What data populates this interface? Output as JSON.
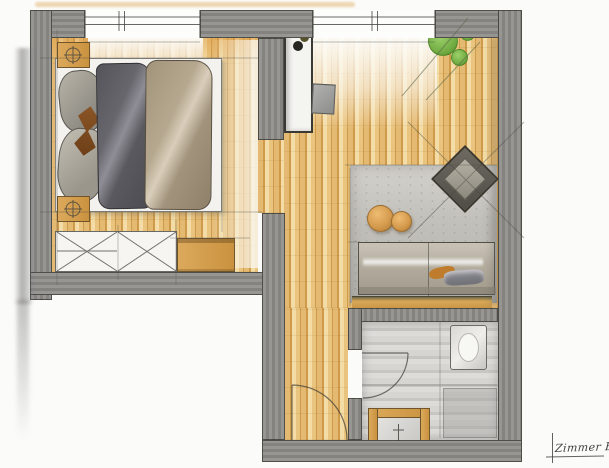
{
  "annotation": {
    "room_label": "Zimmer B"
  },
  "colors": {
    "paper": "#fbfbf9",
    "wall": "#8e8d8a",
    "wall-dark": "#6f6e6b",
    "wood": "#e4ba72",
    "wood-dark": "#cf9a49",
    "wood-light": "#f3dca6",
    "wood-furniture": "#dca95c",
    "rug": "#c6c4bf",
    "bath-floor": "#cfcecb",
    "mattress": "#f3f2ef",
    "duvet-dark": "#5e5d63",
    "duvet-light": "#b2a48c",
    "pouf": "#d59b4e",
    "plant": "#74ae45",
    "plant-dark": "#4e8a28",
    "sofa": "#b7b0a3",
    "pencil": "#55544e",
    "ink": "#403f3a"
  },
  "rooms": [
    {
      "name": "bedroom",
      "furniture": [
        "double-bed",
        "nightstand-left-top",
        "nightstand-left-bottom",
        "wardrobe",
        "dresser"
      ]
    },
    {
      "name": "study-corner",
      "furniture": [
        "desk",
        "desk-chair"
      ]
    },
    {
      "name": "living-area",
      "furniture": [
        "sofa",
        "armchair",
        "pouf",
        "pouf",
        "rug",
        "potted-plant",
        "wood-ledge"
      ]
    },
    {
      "name": "bathroom",
      "furniture": [
        "shower",
        "washbasin"
      ]
    },
    {
      "name": "hallway",
      "furniture": [
        "entry-door",
        "bathroom-door"
      ]
    }
  ]
}
